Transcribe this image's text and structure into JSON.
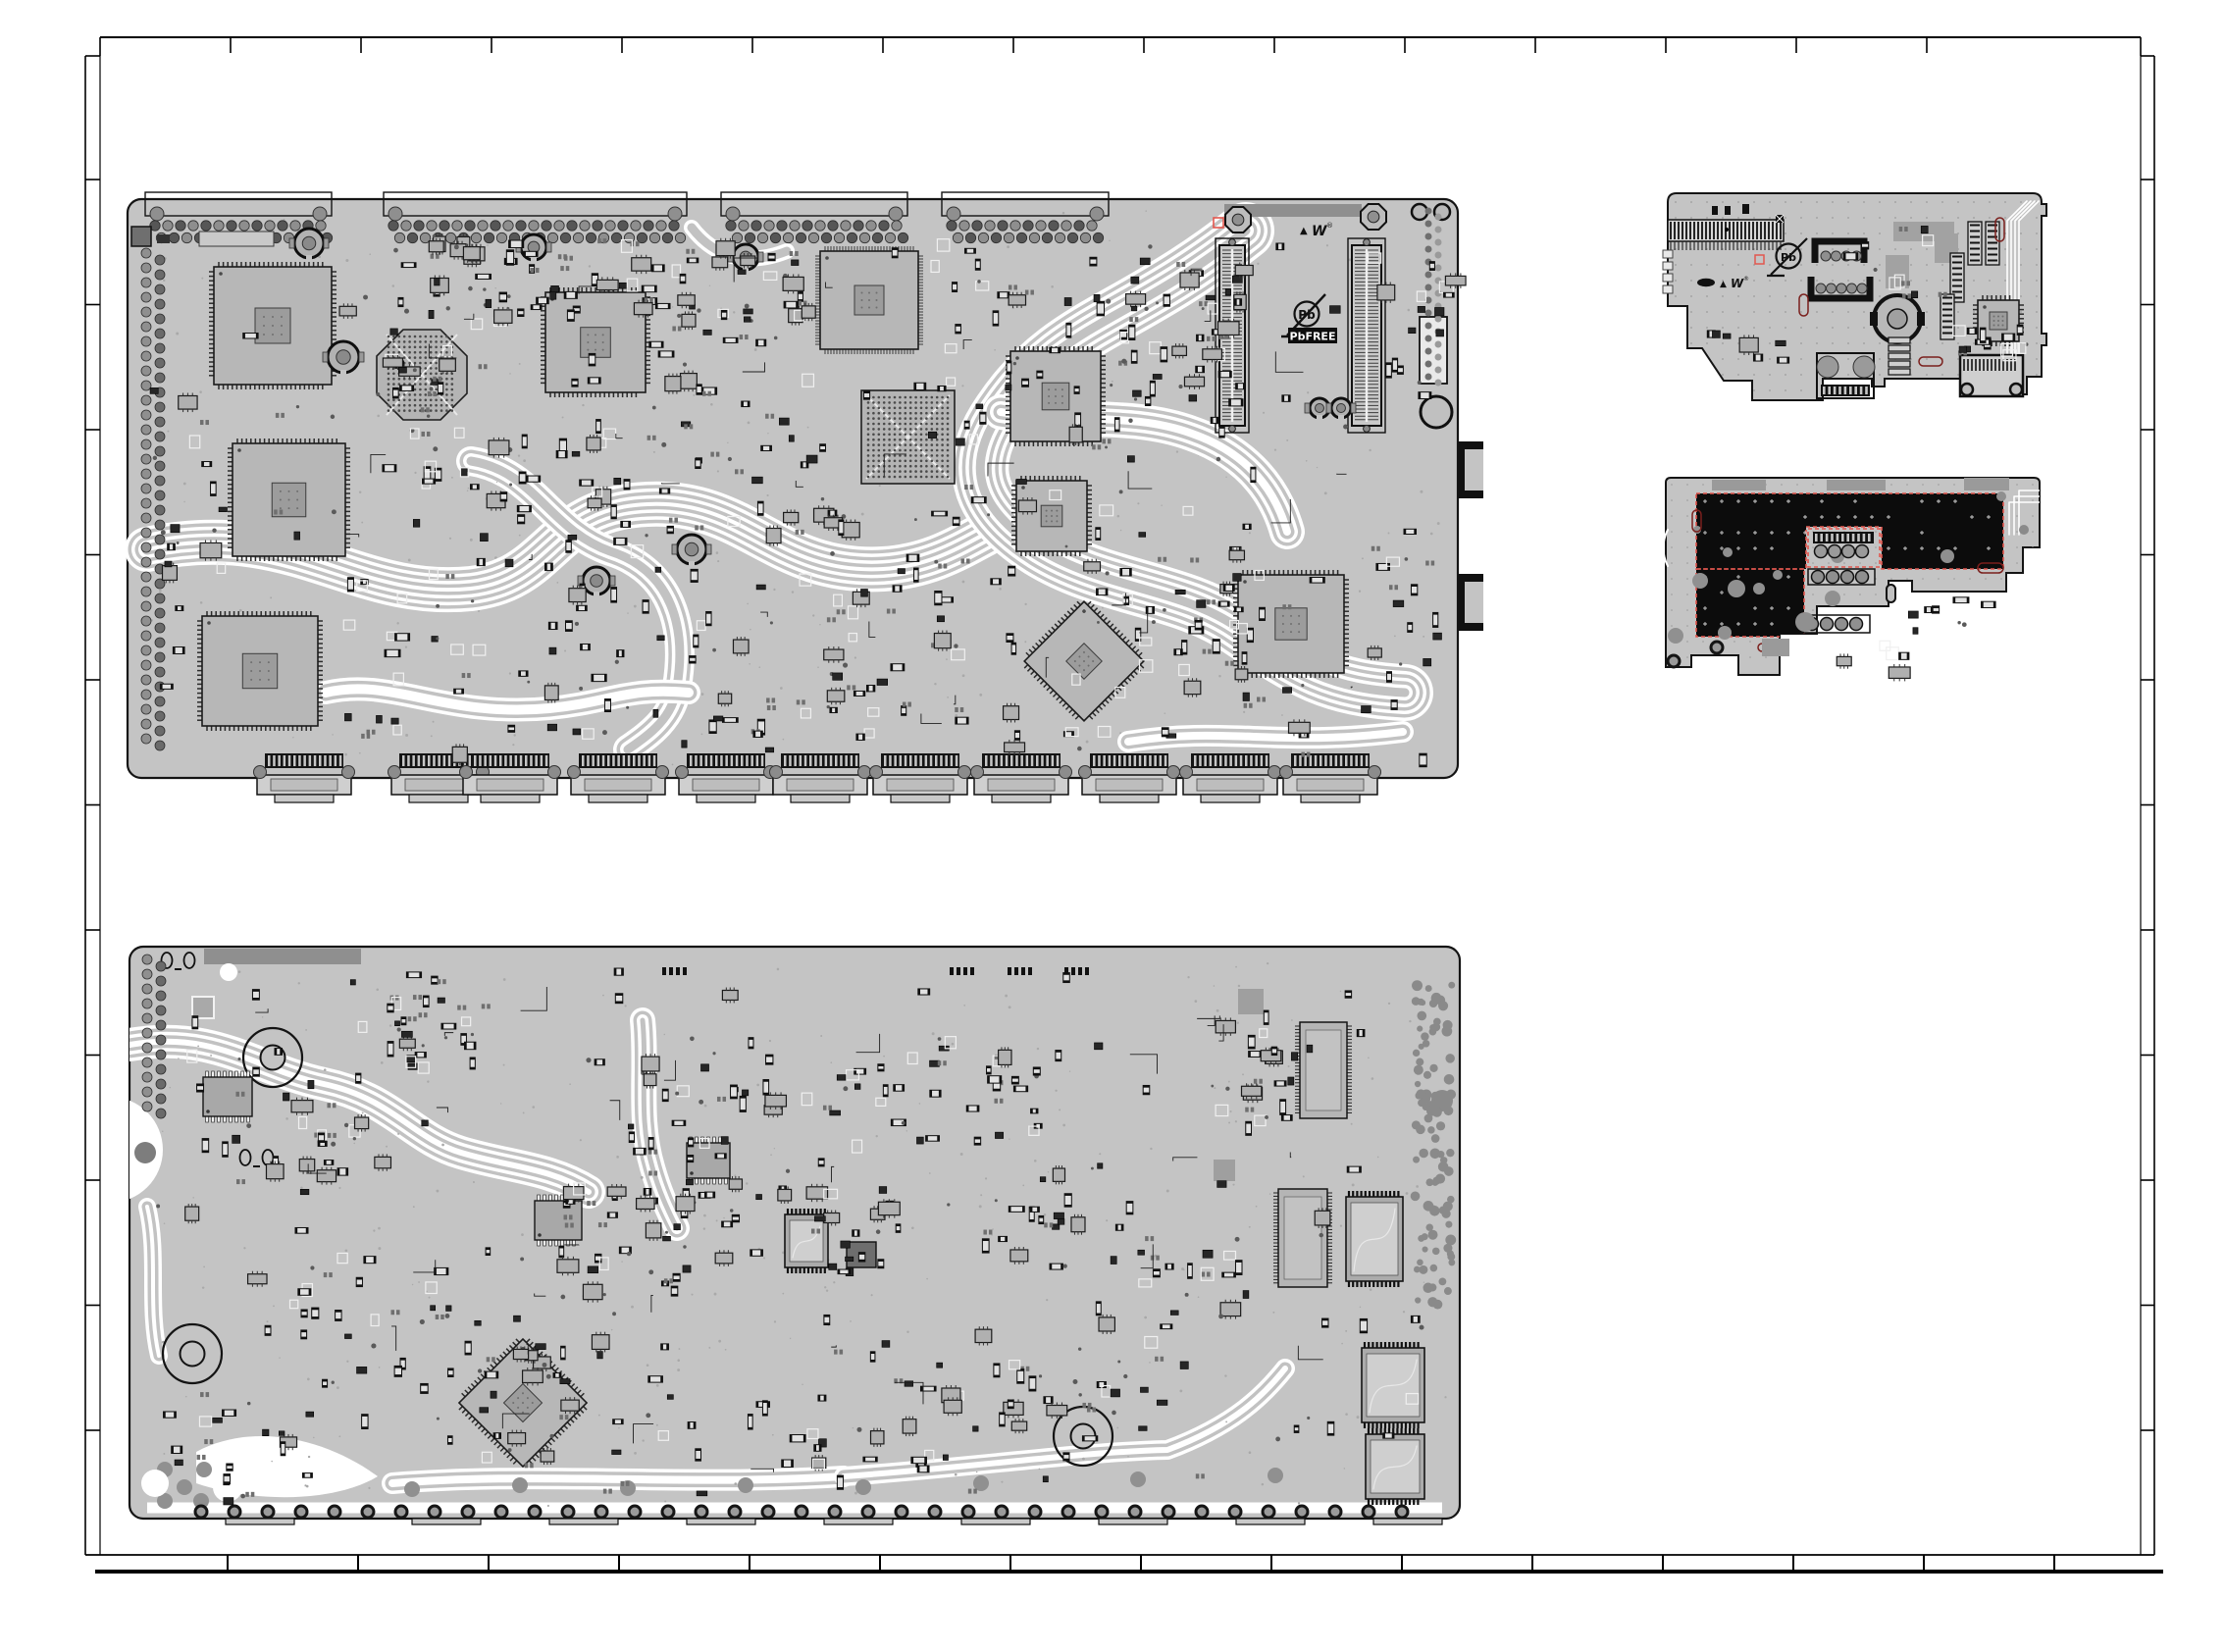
{
  "document": {
    "kind": "pcb-component-layout-drawing",
    "sheet_background": "#ffffff"
  },
  "labels": {
    "pb": "Pb",
    "pb_free": "PbFREE",
    "warning_triangle": "▲",
    "ul_mark": "W",
    "registered": "®"
  },
  "icons": {
    "pb-free-logo": "circle with Pb crossed by diagonal slash",
    "pb-free-badge": "black box with white PbFREE text",
    "ul-recognized-mark": "triangle + stylized W + registered sign",
    "fiducial-target-icon": "concentric circles",
    "copper-zone": "solid black pour outlined with red dashed line"
  },
  "palette": {
    "board": "#c4c4c4",
    "board_stroke": "#141414",
    "comp_dark": "#161616",
    "comp_mid": "#8e8e8e",
    "comp_light": "#e2e2e2",
    "inner_ic": "#9c9c9c",
    "trace_white": "#ffffff",
    "trace_gray": "#c2c2c2",
    "copper_black": "#0c0c0c",
    "accent_red": "#cf3a36",
    "red_outline": "#e2574e",
    "frame": "#000000"
  },
  "boards": [
    {
      "id": "main-board-top-view"
    },
    {
      "id": "main-board-bottom-view"
    },
    {
      "id": "sub-board-top-view"
    },
    {
      "id": "sub-board-bottom-view"
    }
  ]
}
